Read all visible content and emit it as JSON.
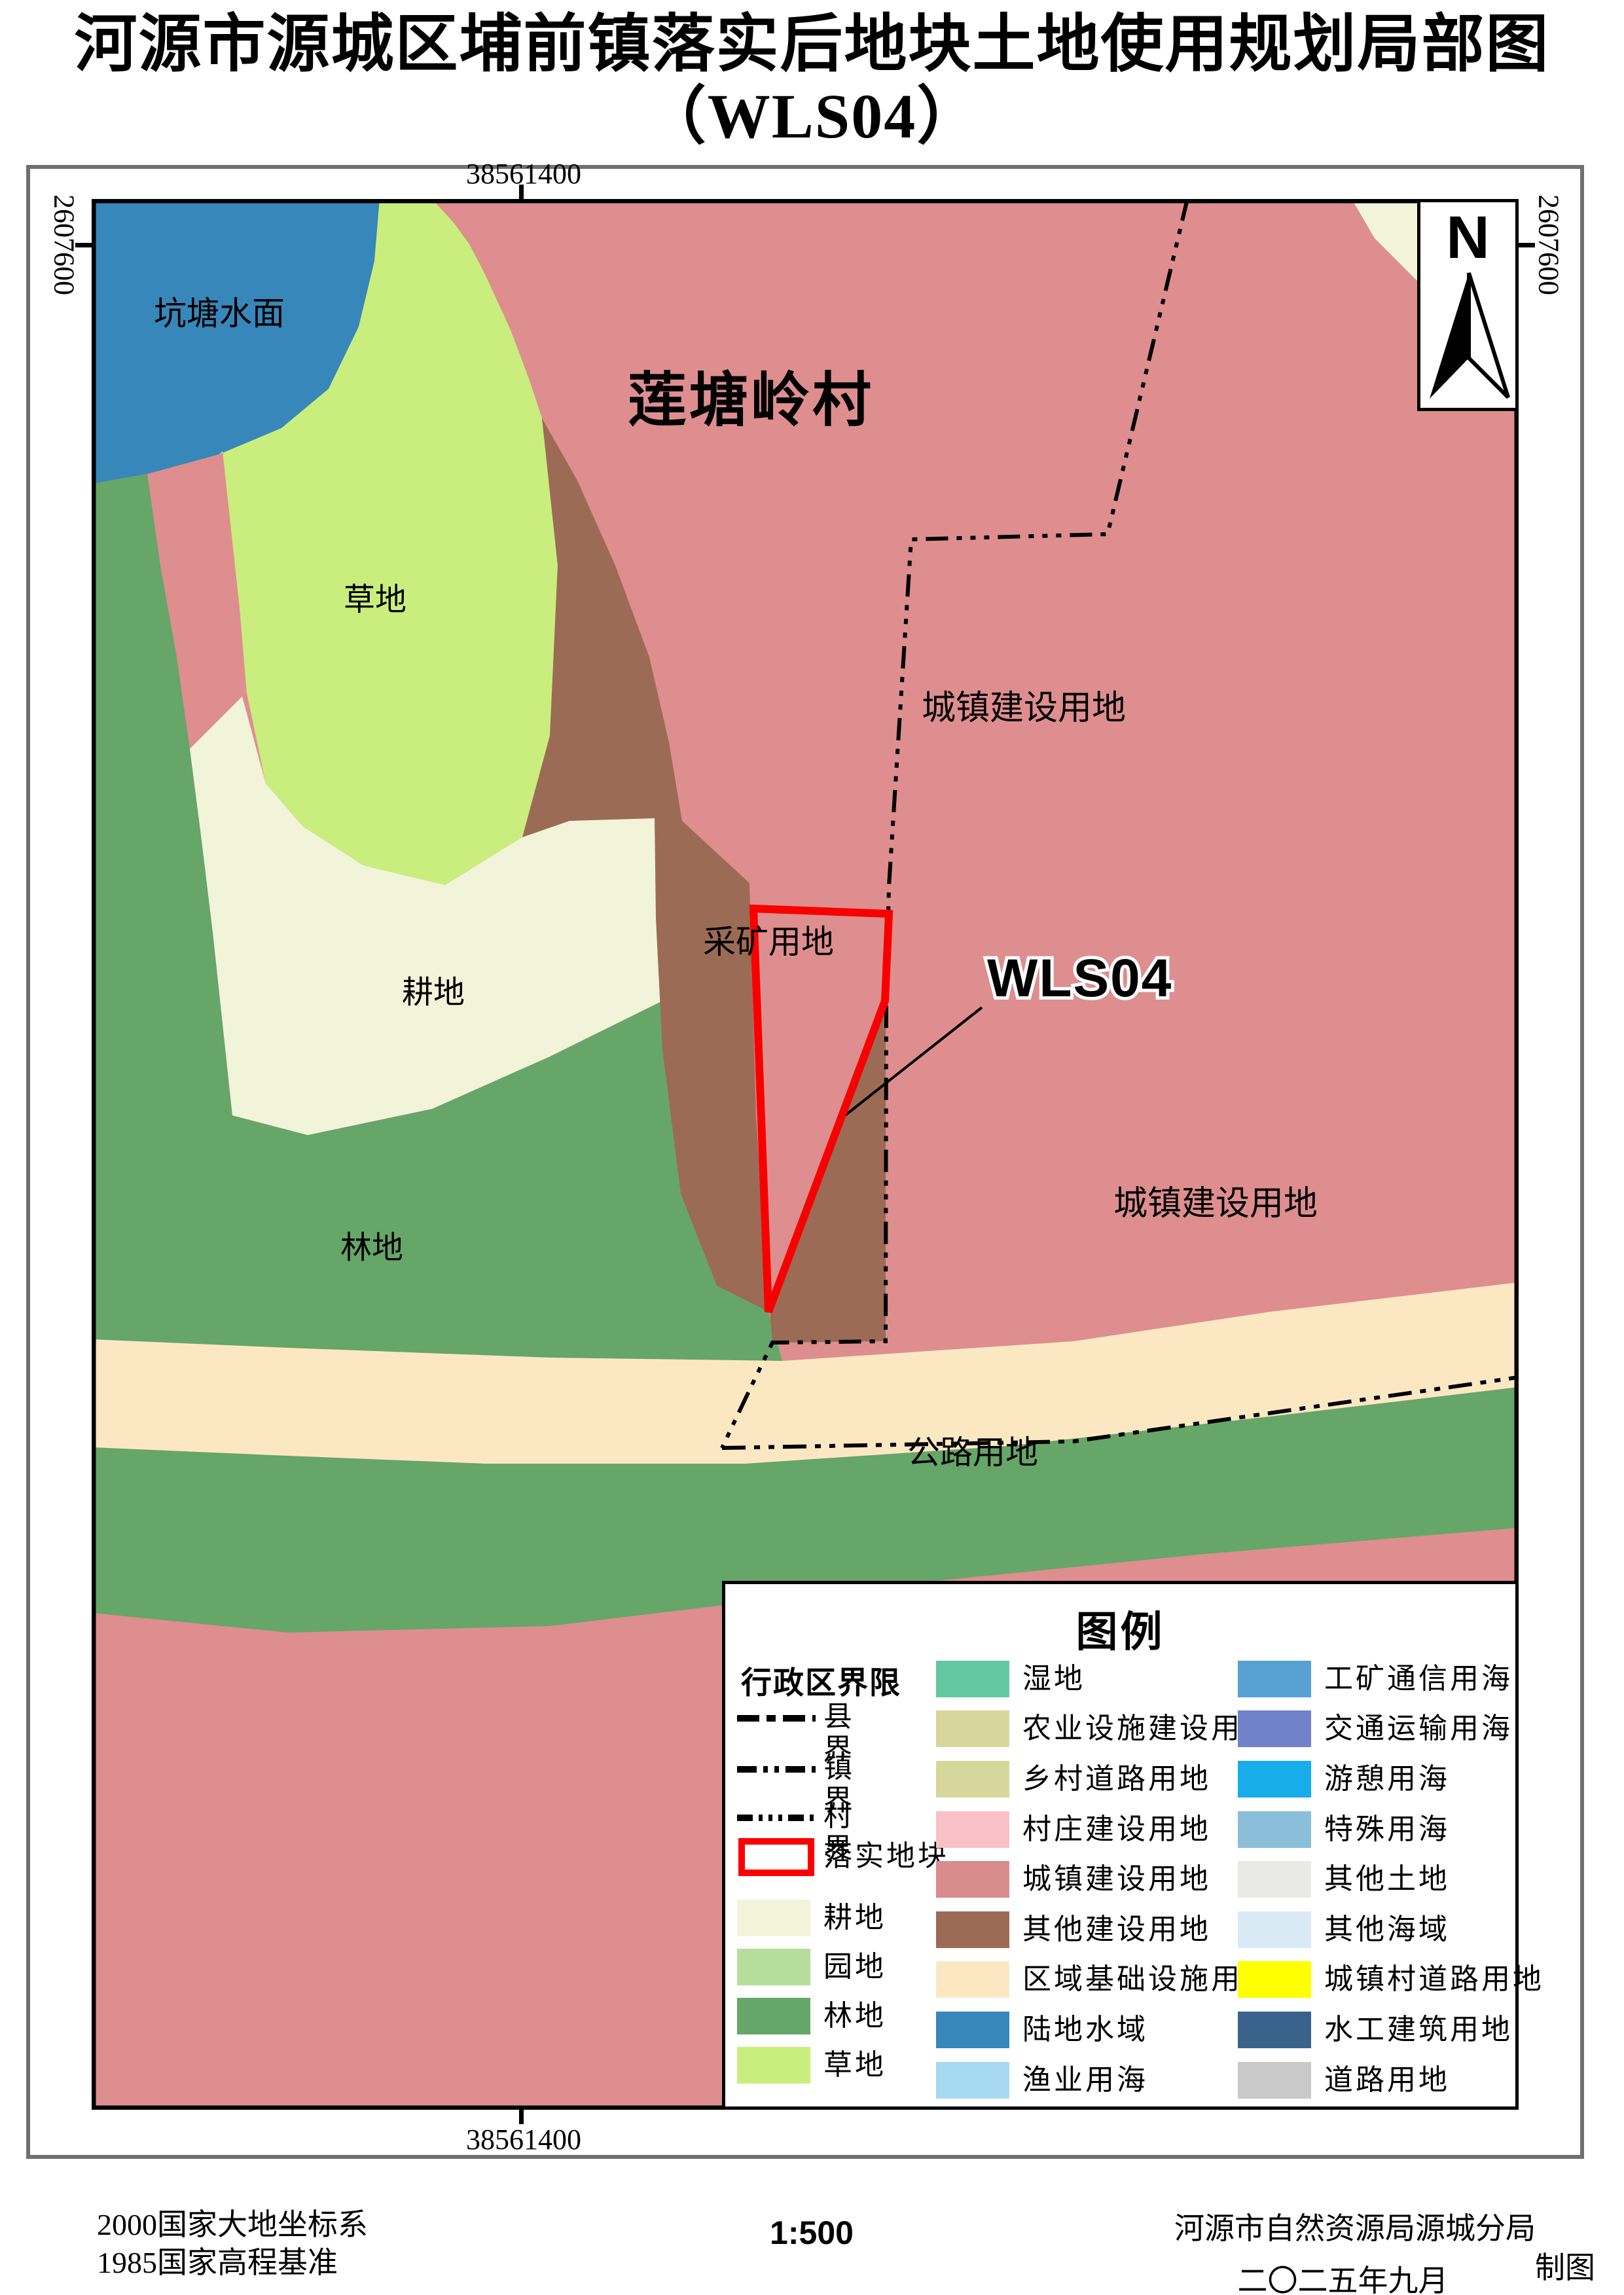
{
  "title": {
    "line1": "河源市源城区埔前镇落实后地块土地使用规划局部图",
    "line2": "（WLS04）"
  },
  "coords": {
    "top": "38561400",
    "bottom": "38561400",
    "left": "2607600",
    "right": "2607600"
  },
  "north_label": "N",
  "map_labels": {
    "pond": "坑塘水面",
    "village": "莲塘岭村",
    "town_upper": "城镇建设用地",
    "grass": "草地",
    "farmland": "耕地",
    "mining": "采矿用地",
    "forest": "林地",
    "town_lower": "城镇建设用地",
    "highway": "公路用地",
    "plot_code": "WLS04",
    "clipped": "坑"
  },
  "map_colors": {
    "town": "#DE8E8E",
    "pond": "#3787BA",
    "grass": "#C9EE7D",
    "farmland": "#F2F4DA",
    "forest": "#66A668",
    "other_construction": "#9C6B55",
    "infrastructure": "#FBE8C3",
    "topright_farmland": "#F2F4DA",
    "plot_outline": "#F80000",
    "boundary": "#000000"
  },
  "legend": {
    "title": "图例",
    "admin_header": "行政区界限",
    "boundaries": [
      {
        "label": "县界"
      },
      {
        "label": "镇界"
      },
      {
        "label": "村界"
      }
    ],
    "plot": {
      "label": "落实地块",
      "color": "#FF0000"
    },
    "left_items": [
      {
        "label": "耕地",
        "color": "#F2F4DA"
      },
      {
        "label": "园地",
        "color": "#B7DD9C"
      },
      {
        "label": "林地",
        "color": "#66A668"
      },
      {
        "label": "草地",
        "color": "#C9EE7D"
      }
    ],
    "mid_items": [
      {
        "label": "湿地",
        "color": "#63C8A2"
      },
      {
        "label": "农业设施建设用地",
        "color": "#D7D79B"
      },
      {
        "label": "乡村道路用地",
        "color": "#D7D79B"
      },
      {
        "label": "村庄建设用地",
        "color": "#F9C1C5"
      },
      {
        "label": "城镇建设用地",
        "color": "#D98C8C"
      },
      {
        "label": "其他建设用地",
        "color": "#9C6B55"
      },
      {
        "label": "区域基础设施用地",
        "color": "#FBE8C3"
      },
      {
        "label": "陆地水域",
        "color": "#3787BA"
      },
      {
        "label": "渔业用海",
        "color": "#A7DAF2"
      }
    ],
    "right_items": [
      {
        "label": "工矿通信用海",
        "color": "#58A2D3"
      },
      {
        "label": "交通运输用海",
        "color": "#7082C9"
      },
      {
        "label": "游憩用海",
        "color": "#17ACEA"
      },
      {
        "label": "特殊用海",
        "color": "#8ABED9"
      },
      {
        "label": "其他土地",
        "color": "#E9E9E7"
      },
      {
        "label": "其他海域",
        "color": "#DAEAF5"
      },
      {
        "label": "城镇村道路用地",
        "color": "#FFFF00"
      },
      {
        "label": "水工建筑用地",
        "color": "#3A638C"
      },
      {
        "label": "道路用地",
        "color": "#C9C9C9"
      }
    ]
  },
  "footer": {
    "datum1": "2000国家大地坐标系",
    "datum2": "1985国家高程基准",
    "scale": "1:500",
    "agency": "河源市自然资源局源城分局",
    "date": "二〇二五年九月",
    "credit": "制图"
  }
}
